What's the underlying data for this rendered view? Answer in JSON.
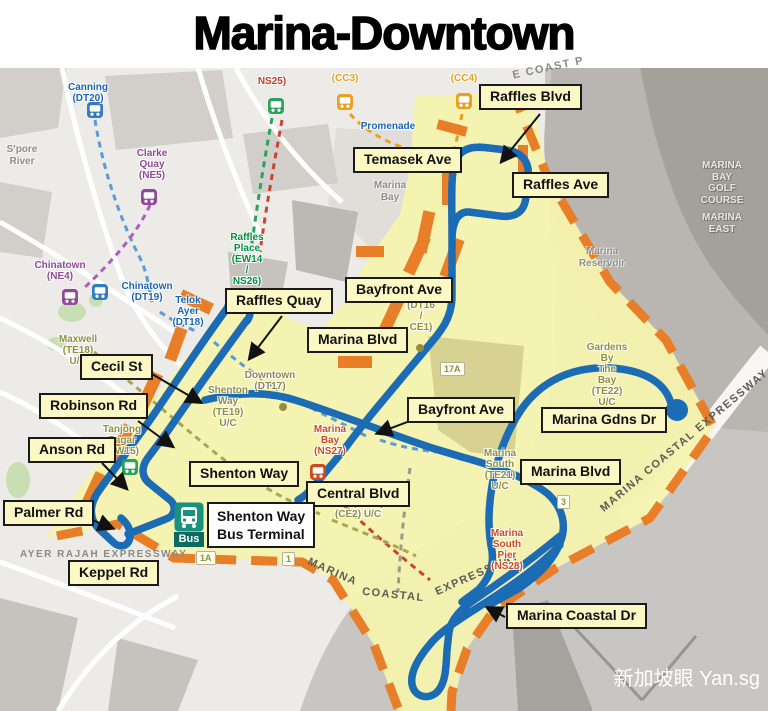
{
  "title": "Marina-Downtown",
  "watermark": "新加坡眼 Yan.sg",
  "colors": {
    "route_blue": "#1b6cb5",
    "zone_yellow": "#f6f3ae",
    "zone_border_orange": "#e87e28",
    "label_bg": "#fbf8c6",
    "terminal_teal": "#18927f"
  },
  "road_labels": {
    "raffles_blvd": "Raffles Blvd",
    "temasek_ave": "Temasek Ave",
    "raffles_ave": "Raffles Ave",
    "bayfront_ave_north": "Bayfront Ave",
    "raffles_quay": "Raffles Quay",
    "marina_blvd_center": "Marina Blvd",
    "cecil_st": "Cecil St",
    "robinson_rd": "Robinson Rd",
    "bayfront_ave_south": "Bayfront Ave",
    "marina_gdns_dr": "Marina Gdns Dr",
    "anson_rd": "Anson Rd",
    "shenton_way": "Shenton Way",
    "marina_blvd_east": "Marina Blvd",
    "central_blvd": "Central Blvd",
    "palmer_rd": "Palmer Rd",
    "keppel_rd": "Keppel Rd",
    "marina_coastal_dr": "Marina Coastal Dr"
  },
  "terminal": {
    "name": "Shenton Way\nBus Terminal",
    "icon_text": "Bus"
  },
  "stations": {
    "canning": "Canning\n(DT20)",
    "clarke_quay": "Clarke\nQuay\n(NE5)",
    "ns25": "NS25)",
    "cc3": "(CC3)",
    "cc4": "(CC4)",
    "promenade": "Promenade",
    "raffles_place": "Raffles\nPlace\n(EW14\n/\nNS26)",
    "chinatown_ne4": "Chinatown\n(NE4)",
    "chinatown_dt19": "Chinatown\n(DT19)",
    "telok_ayer": "Telok\nAyer\n(DT18)",
    "maxwell": "Maxwell\n(TE18)\nU/C",
    "downtown": "Downtown\n(DT17)",
    "bayfront": "(DT16\n/\nCE1)",
    "shenton_way_stn": "Shenton\nWay\n(TE19)\nU/C",
    "tanjong_pagar": "Tanjong\nPagar\n(EW15)",
    "marina_bay_ns27": "Marina\nBay\n(NS27)",
    "marina_bay_te20": "Bay  (TE20)\n(CE2)  U/C",
    "gardens_by_the_bay": "Gardens\nBy\nThe\nBay\n(TE22)\nU/C",
    "marina_south": "Marina\nSouth\n(TE21)\nU/C",
    "marina_south_pier": "Marina\nSouth\nPier\n(NS28)"
  },
  "areas": {
    "spore_river": "S'pore\nRiver",
    "marina_bay": "Marina\nBay",
    "marina_reservoir": "Marina\nReservoir",
    "golf_course": "MARINA\nBAY\nGOLF\nCOURSE",
    "marina_east": "MARINA\nEAST"
  },
  "expressways": {
    "marina_coastal": "MARINA COASTAL EXPRESSWAY",
    "mce_w1": "MARINA",
    "mce_w2": "COASTAL",
    "mce_w3": "EXPRESSWAY",
    "ayer_rajah": "AYER RAJAH EXPRESSWAY",
    "e_coast": "E COAST P"
  },
  "badges": {
    "b17a": "17A",
    "b3": "3",
    "b1a": "1A",
    "b1": "1"
  }
}
